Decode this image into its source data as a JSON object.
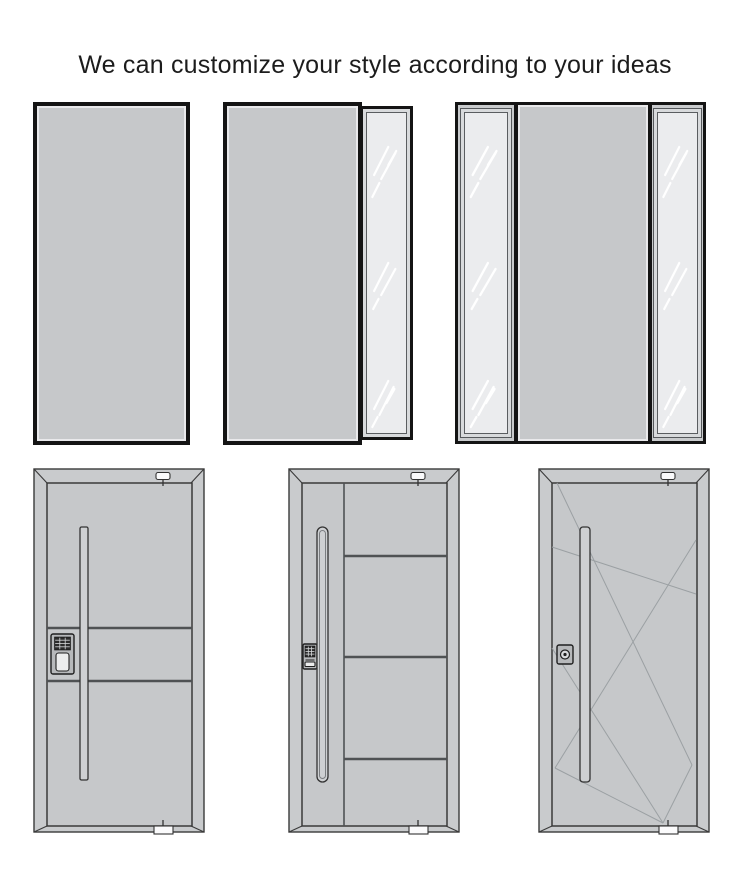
{
  "title": "We can customize your style according to your ideas",
  "colors": {
    "page_bg": "#ffffff",
    "text": "#1c1c1c",
    "door_fill": "#c6c8ca",
    "frame_fill": "#c9cbcd",
    "glass_fill": "#ebecee",
    "glass_frame_fill": "#d8dadc",
    "border_black": "#141414",
    "outline_dark": "#3a3a3a",
    "panel_line": "#4f5254",
    "decor_line": "#9ba0a3",
    "streak": "#ffffff",
    "handle_fill": "#ced0d2",
    "lock_body": "#b7b9bb",
    "keypad_fill": "#2b2b2b",
    "latch_fill": "#fbfbfc"
  },
  "configurations": [
    {
      "name": "single-panel-door"
    },
    {
      "name": "door-with-right-sidelight"
    },
    {
      "name": "door-with-double-sidelights"
    }
  ],
  "designs": [
    {
      "name": "door-with-cross-grooves",
      "lock": "keypad-smart-lock",
      "handle": "long-bar-handle"
    },
    {
      "name": "door-with-four-horizontal-panels",
      "lock": "keypad-smart-lock",
      "handle": "long-capsule-handle"
    },
    {
      "name": "door-with-diagonal-grooves",
      "lock": "cylinder-lock",
      "handle": "long-bar-handle"
    }
  ]
}
